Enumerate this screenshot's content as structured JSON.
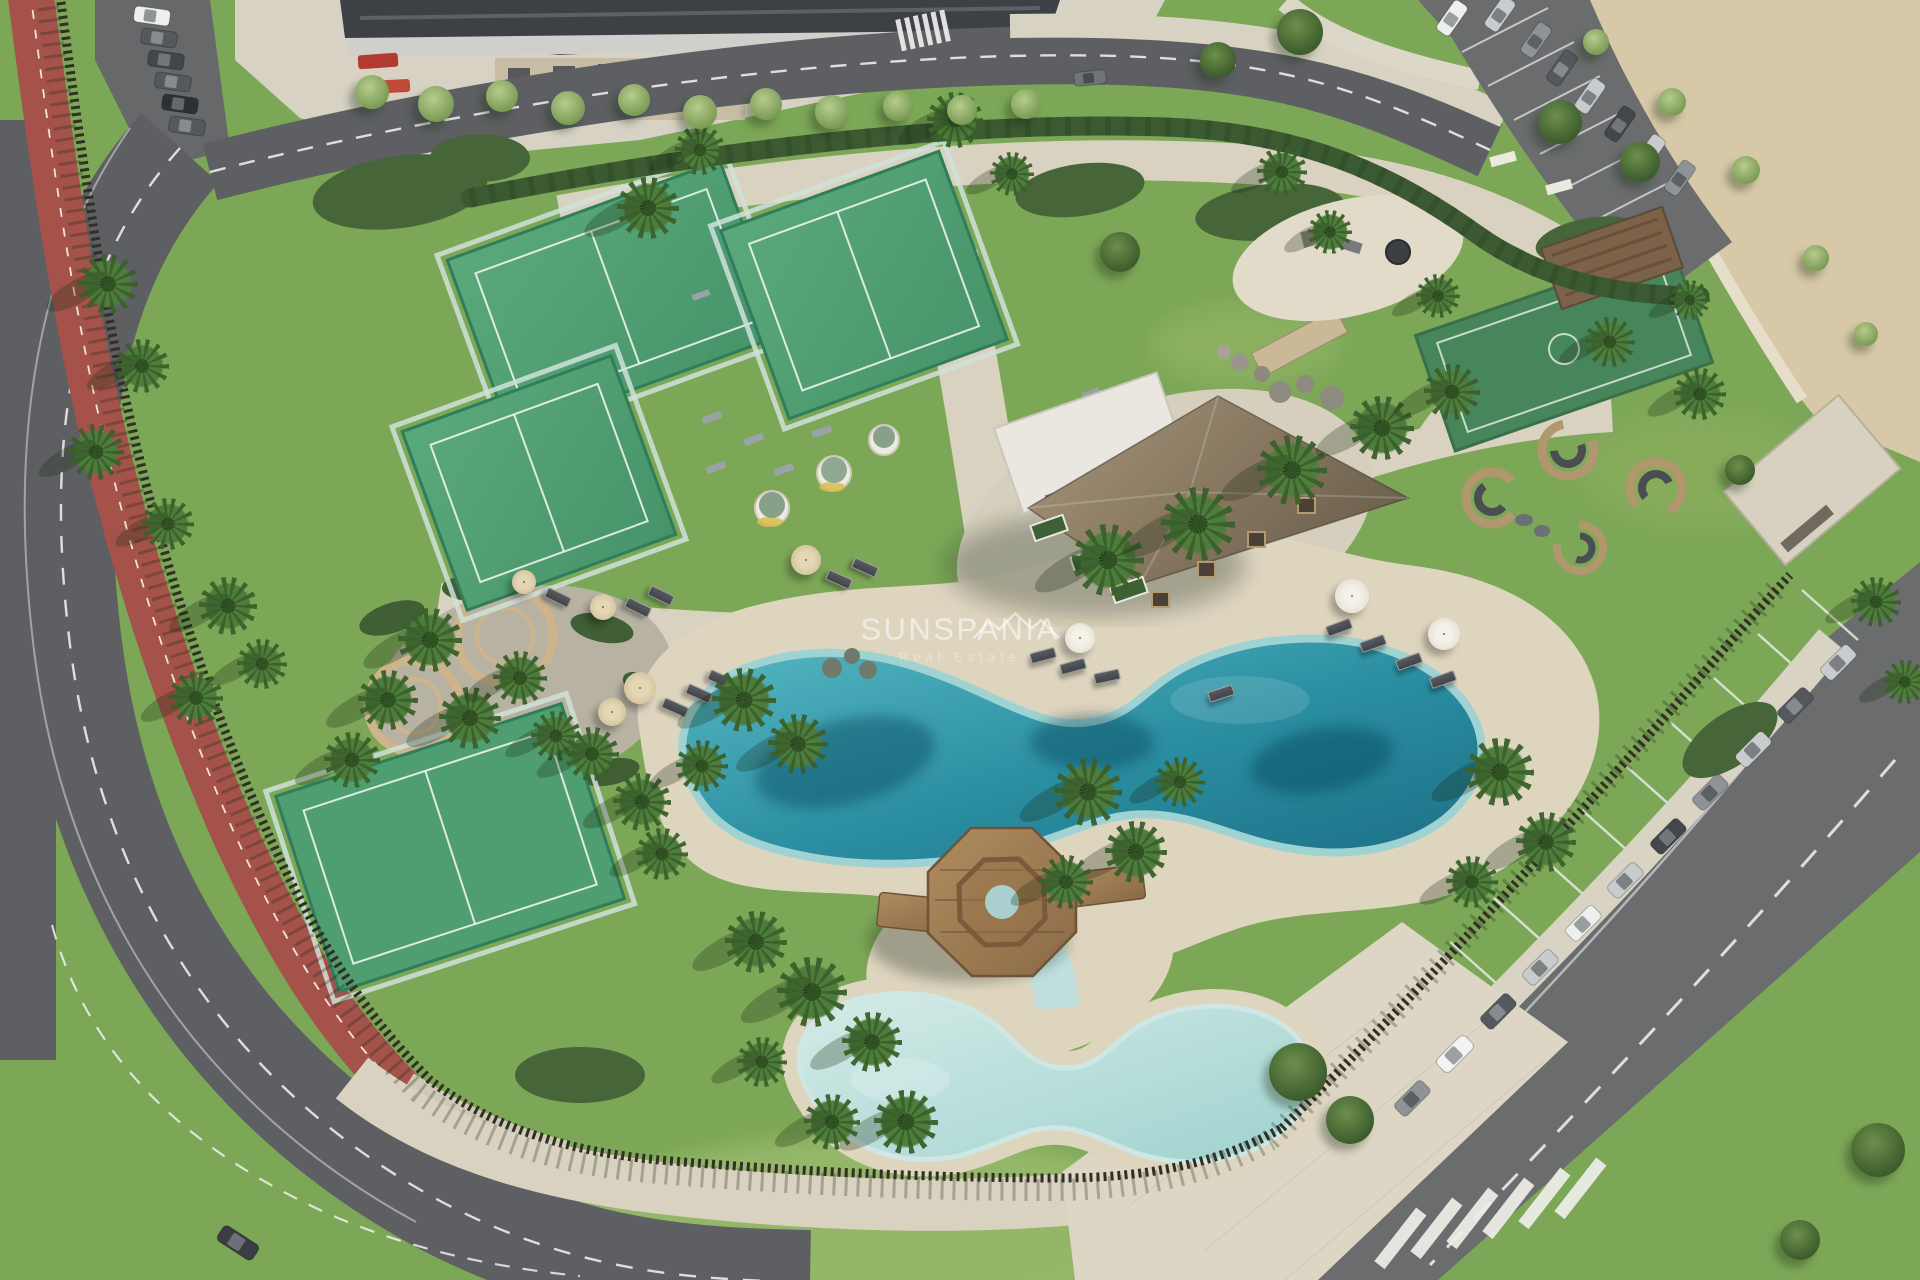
{
  "alt": "Aerial drone view of a coastal resort leisure area: lagoon-style pools with sandy beaches, a wooden gazebo deck, padel courts, a thatched pool bar pavilion, gardens with palm trees, a red bike lane along the perimeter road and parking lots with cars",
  "watermark": {
    "brand": "SUNSPANIA",
    "tagline": "Real Estate",
    "logo": "roofline-icon"
  },
  "palette": {
    "grass": "#7ca757",
    "grassLight": "#a9c478",
    "path": "#d9d2c0",
    "sand": "#ded5bf",
    "sandLot": "#d7c9a7",
    "road": "#5d5f62",
    "asphaltLot": "#6a6c6e",
    "bikeLane": "#a4524a",
    "pool": "#2a8da0",
    "poolShallow": "#9fd2d2",
    "kidsPool": "#bfe0dd",
    "court": "#4f9e71",
    "hedge": "#3b5a32",
    "fence": "#332f27",
    "thatch": "#8d7c64",
    "whiteRoof": "#e9e7e0",
    "wood": "#a9895d",
    "building": "#3d4145"
  }
}
